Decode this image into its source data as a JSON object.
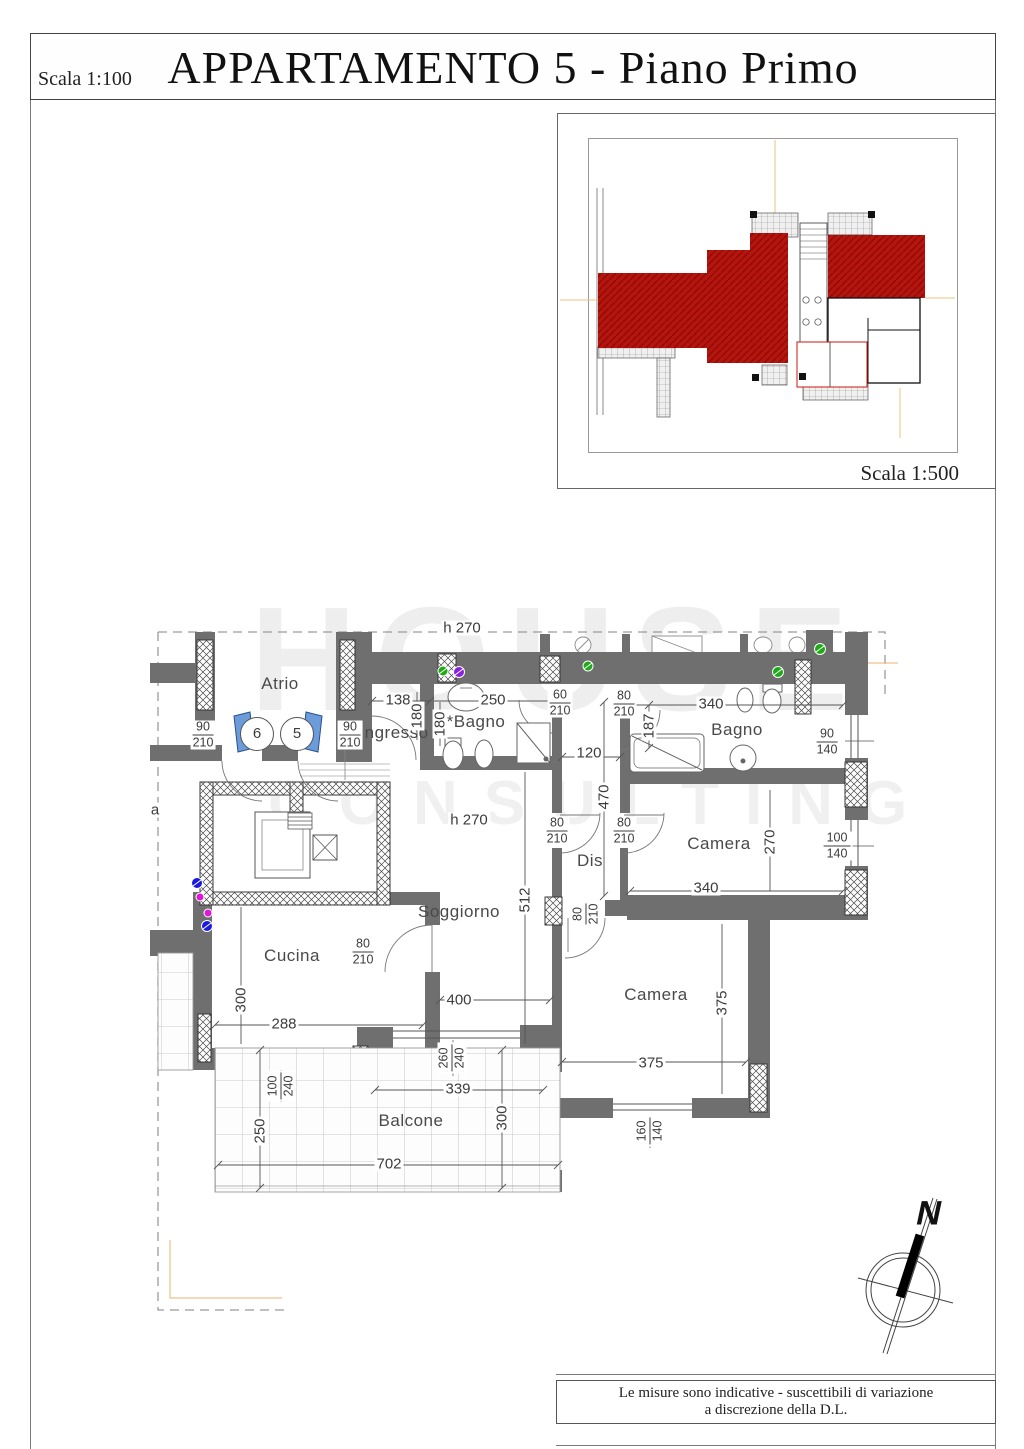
{
  "page": {
    "title": "APPARTAMENTO 5 - Piano Primo",
    "scale_main": "Scala 1:100",
    "scale_overview": "Scala 1:500",
    "footer_line1": "Le misure sono indicative - suscettibili di variazione",
    "footer_line2": "a discrezione della D.L.",
    "north_label": "N"
  },
  "watermark": {
    "line1": "HOUSE",
    "line2": "CONSULTING"
  },
  "plan": {
    "rooms": [
      {
        "label": "Atrio",
        "x": 280,
        "y": 684
      },
      {
        "label": "Ingresso",
        "x": 394,
        "y": 733
      },
      {
        "label": "*Bagno",
        "x": 476,
        "y": 722
      },
      {
        "label": "Bagno",
        "x": 737,
        "y": 730
      },
      {
        "label": "Camera",
        "x": 719,
        "y": 844
      },
      {
        "label": "Dis",
        "x": 590,
        "y": 861
      },
      {
        "label": "Soggiorno",
        "x": 459,
        "y": 912
      },
      {
        "label": "Cucina",
        "x": 292,
        "y": 956
      },
      {
        "label": "Camera",
        "x": 656,
        "y": 995
      },
      {
        "label": "Balcone",
        "x": 411,
        "y": 1121
      }
    ],
    "door_numbers": [
      {
        "label": "6",
        "x": 257,
        "y": 734
      },
      {
        "label": "5",
        "x": 297,
        "y": 734
      }
    ],
    "dimensions": [
      {
        "text": "h 270",
        "x": 462,
        "y": 628,
        "rot": false
      },
      {
        "text": "138",
        "x": 398,
        "y": 700,
        "rot": false
      },
      {
        "text": "250",
        "x": 493,
        "y": 700,
        "rot": false
      },
      {
        "text": "340",
        "x": 711,
        "y": 704,
        "rot": false
      },
      {
        "text": "120",
        "x": 589,
        "y": 753,
        "rot": false
      },
      {
        "text": "180",
        "x": 417,
        "y": 716,
        "rot": true
      },
      {
        "text": "180",
        "x": 440,
        "y": 724,
        "rot": true
      },
      {
        "text": "187",
        "x": 649,
        "y": 726,
        "rot": true
      },
      {
        "text": "470",
        "x": 604,
        "y": 797,
        "rot": true
      },
      {
        "text": "h 270",
        "x": 469,
        "y": 820,
        "rot": false
      },
      {
        "text": "270",
        "x": 770,
        "y": 842,
        "rot": true
      },
      {
        "text": "340",
        "x": 706,
        "y": 888,
        "rot": false
      },
      {
        "text": "512",
        "x": 525,
        "y": 900,
        "rot": true
      },
      {
        "text": "400",
        "x": 459,
        "y": 1000,
        "rot": false
      },
      {
        "text": "300",
        "x": 241,
        "y": 1000,
        "rot": true
      },
      {
        "text": "288",
        "x": 284,
        "y": 1024,
        "rot": false
      },
      {
        "text": "339",
        "x": 458,
        "y": 1089,
        "rot": false
      },
      {
        "text": "375",
        "x": 722,
        "y": 1003,
        "rot": true
      },
      {
        "text": "375",
        "x": 651,
        "y": 1063,
        "rot": false
      },
      {
        "text": "300",
        "x": 502,
        "y": 1118,
        "rot": true
      },
      {
        "text": "250",
        "x": 260,
        "y": 1131,
        "rot": true
      },
      {
        "text": "702",
        "x": 389,
        "y": 1164,
        "rot": false
      },
      {
        "text": "a",
        "x": 155,
        "y": 810,
        "rot": false
      }
    ],
    "dimension_fractions": [
      {
        "num": "90",
        "den": "210",
        "x": 203,
        "y": 735,
        "rot": false
      },
      {
        "num": "90",
        "den": "210",
        "x": 350,
        "y": 735,
        "rot": false
      },
      {
        "num": "60",
        "den": "210",
        "x": 560,
        "y": 703,
        "rot": false
      },
      {
        "num": "80",
        "den": "210",
        "x": 624,
        "y": 704,
        "rot": false
      },
      {
        "num": "90",
        "den": "140",
        "x": 827,
        "y": 742,
        "rot": false
      },
      {
        "num": "80",
        "den": "210",
        "x": 557,
        "y": 831,
        "rot": false
      },
      {
        "num": "80",
        "den": "210",
        "x": 624,
        "y": 831,
        "rot": false
      },
      {
        "num": "100",
        "den": "140",
        "x": 837,
        "y": 846,
        "rot": false
      },
      {
        "num": "80",
        "den": "210",
        "x": 586,
        "y": 914,
        "rot": true
      },
      {
        "num": "80",
        "den": "210",
        "x": 363,
        "y": 952,
        "rot": false
      },
      {
        "num": "100",
        "den": "240",
        "x": 281,
        "y": 1086,
        "rot": true
      },
      {
        "num": "260",
        "den": "240",
        "x": 452,
        "y": 1058,
        "rot": true
      },
      {
        "num": "160",
        "den": "140",
        "x": 650,
        "y": 1131,
        "rot": true
      }
    ]
  },
  "colors": {
    "wall": "#6f6f6f",
    "highlight_red": "#b6150e",
    "door_blue": "#6b9bd8",
    "marker_green": "#1faa18",
    "marker_purple": "#8822dd",
    "marker_blue": "#1a1adf",
    "marker_magenta": "#e016d8"
  }
}
